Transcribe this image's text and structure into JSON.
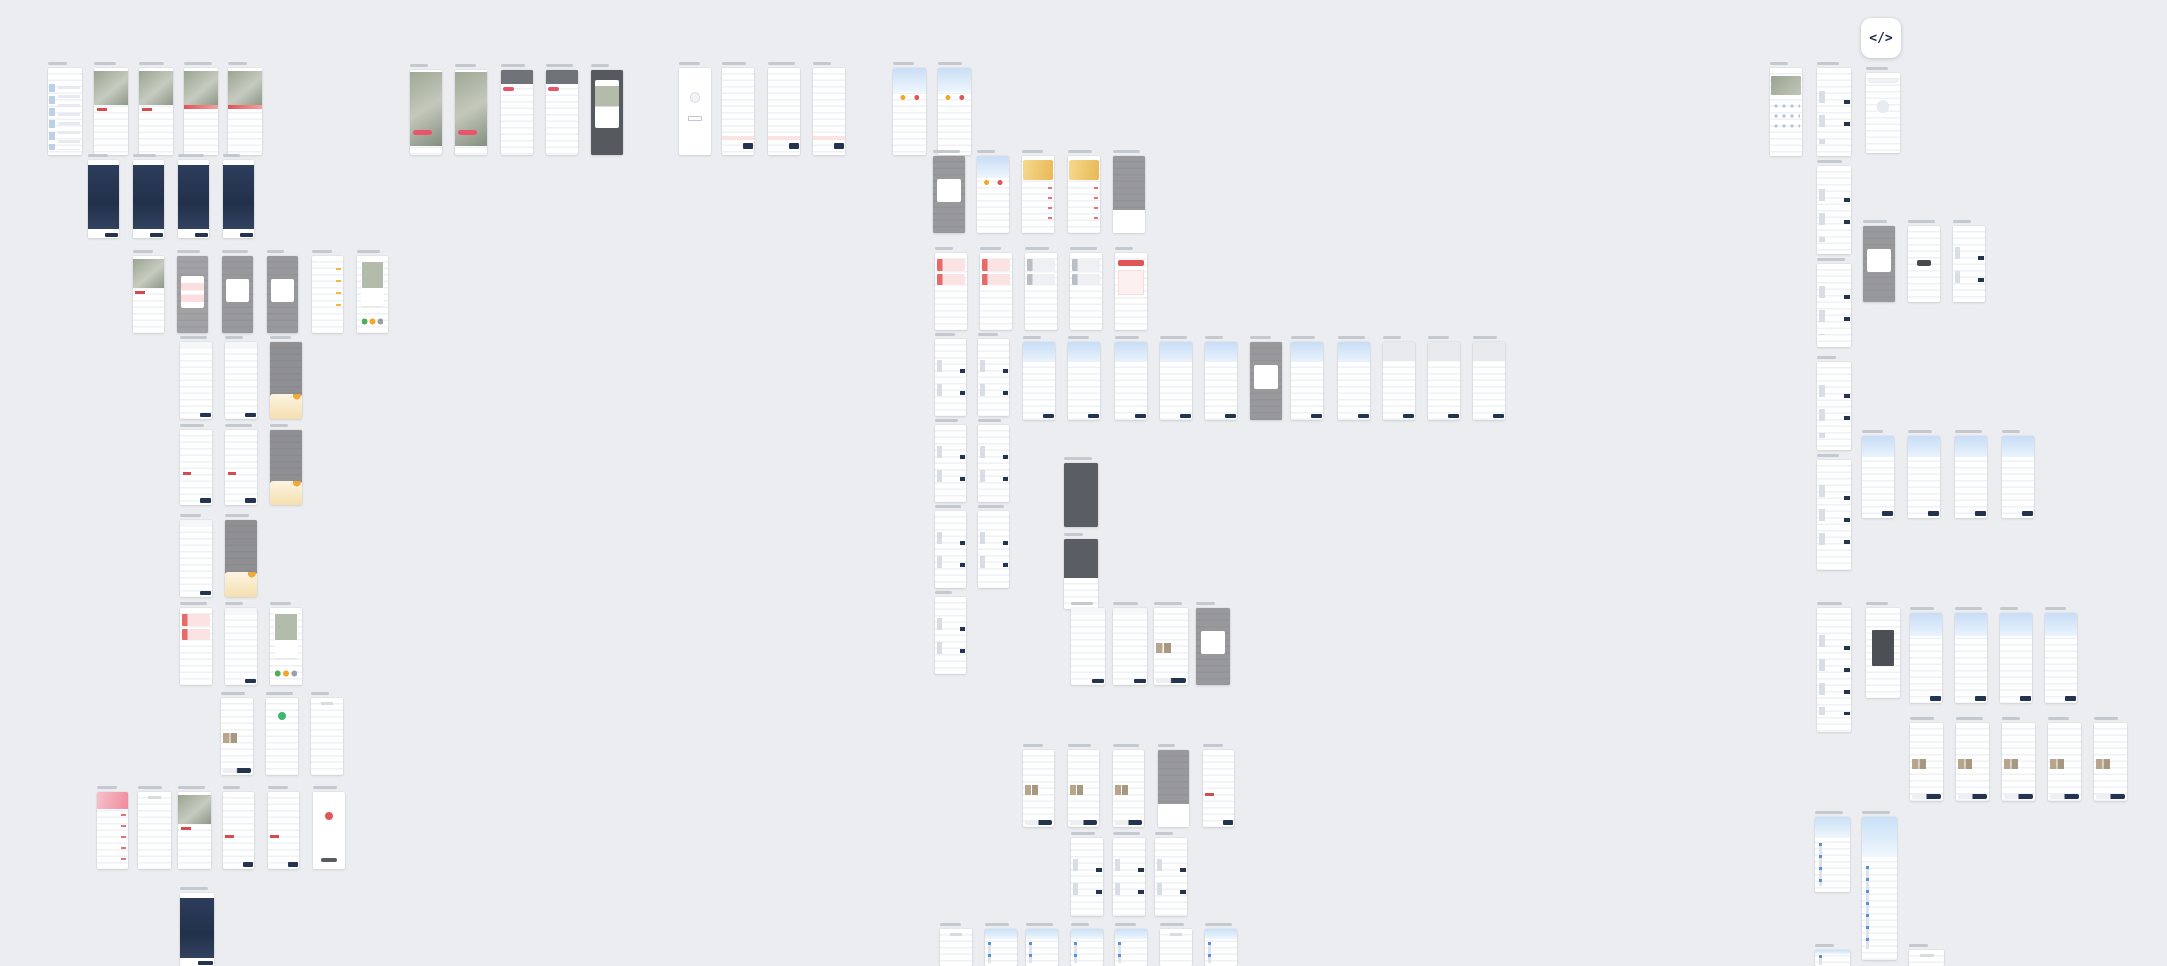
{
  "canvas": {
    "width": 2167,
    "height": 966,
    "background": "#ebedf0"
  },
  "code_button": {
    "label": "</>",
    "x": 1861,
    "y": 18,
    "size": 40
  },
  "colors": {
    "canvas_bg": "#ebedf0",
    "frame_bg": "#ffffff",
    "label_gray": "#c4c8cf",
    "brand_navy": "#24344f",
    "accent_red": "#e05555",
    "accent_pink": "#fbe3e3",
    "header_blue": "#cfe3f7",
    "wallet_gold": "#e9b857",
    "success_green": "#3cb96b",
    "warn_orange": "#f5a623",
    "photo_tone": "#9aa491",
    "dim_overlay": "rgba(70,70,74,0.55)"
  },
  "frames": [
    {
      "x": 48,
      "y": 68,
      "w": 34,
      "h": 87,
      "k": "list-blue"
    },
    {
      "x": 94,
      "y": 68,
      "w": 34,
      "h": 87,
      "k": "detail"
    },
    {
      "x": 139,
      "y": 68,
      "w": 34,
      "h": 87,
      "k": "detail"
    },
    {
      "x": 184,
      "y": 68,
      "w": 34,
      "h": 87,
      "k": "detail-banner"
    },
    {
      "x": 228,
      "y": 68,
      "w": 34,
      "h": 87,
      "k": "detail-banner"
    },
    {
      "x": 88,
      "y": 160,
      "w": 31,
      "h": 78,
      "k": "navy"
    },
    {
      "x": 133,
      "y": 160,
      "w": 31,
      "h": 78,
      "k": "navy"
    },
    {
      "x": 178,
      "y": 160,
      "w": 31,
      "h": 78,
      "k": "navy"
    },
    {
      "x": 223,
      "y": 160,
      "w": 31,
      "h": 78,
      "k": "navy"
    },
    {
      "x": 133,
      "y": 256,
      "w": 31,
      "h": 77,
      "k": "detail"
    },
    {
      "x": 177,
      "y": 256,
      "w": 31,
      "h": 77,
      "k": "dim-pink"
    },
    {
      "x": 222,
      "y": 256,
      "w": 31,
      "h": 77,
      "k": "dim-card"
    },
    {
      "x": 267,
      "y": 256,
      "w": 31,
      "h": 77,
      "k": "dim-card"
    },
    {
      "x": 312,
      "y": 256,
      "w": 31,
      "h": 77,
      "k": "reviews"
    },
    {
      "x": 357,
      "y": 256,
      "w": 31,
      "h": 77,
      "k": "share"
    },
    {
      "x": 180,
      "y": 342,
      "w": 32,
      "h": 77,
      "k": "form"
    },
    {
      "x": 225,
      "y": 342,
      "w": 32,
      "h": 77,
      "k": "form"
    },
    {
      "x": 270,
      "y": 342,
      "w": 32,
      "h": 77,
      "k": "dim-gold"
    },
    {
      "x": 180,
      "y": 430,
      "w": 32,
      "h": 75,
      "k": "pay"
    },
    {
      "x": 225,
      "y": 430,
      "w": 32,
      "h": 75,
      "k": "pay"
    },
    {
      "x": 270,
      "y": 430,
      "w": 32,
      "h": 75,
      "k": "dim-gold"
    },
    {
      "x": 180,
      "y": 520,
      "w": 32,
      "h": 77,
      "k": "form"
    },
    {
      "x": 225,
      "y": 520,
      "w": 32,
      "h": 77,
      "k": "dim-gold"
    },
    {
      "x": 180,
      "y": 608,
      "w": 32,
      "h": 77,
      "k": "coupons"
    },
    {
      "x": 225,
      "y": 608,
      "w": 32,
      "h": 77,
      "k": "form"
    },
    {
      "x": 270,
      "y": 608,
      "w": 32,
      "h": 77,
      "k": "share"
    },
    {
      "x": 221,
      "y": 698,
      "w": 32,
      "h": 77,
      "k": "aftersale"
    },
    {
      "x": 266,
      "y": 698,
      "w": 32,
      "h": 77,
      "k": "success"
    },
    {
      "x": 311,
      "y": 698,
      "w": 32,
      "h": 77,
      "k": "doc"
    },
    {
      "x": 97,
      "y": 792,
      "w": 31,
      "h": 77,
      "k": "promo"
    },
    {
      "x": 138,
      "y": 792,
      "w": 33,
      "h": 77,
      "k": "doc"
    },
    {
      "x": 178,
      "y": 792,
      "w": 33,
      "h": 77,
      "k": "detail"
    },
    {
      "x": 223,
      "y": 792,
      "w": 31,
      "h": 77,
      "k": "pay"
    },
    {
      "x": 268,
      "y": 792,
      "w": 31,
      "h": 77,
      "k": "pay"
    },
    {
      "x": 313,
      "y": 792,
      "w": 32,
      "h": 77,
      "k": "error"
    },
    {
      "x": 180,
      "y": 893,
      "w": 34,
      "h": 73,
      "k": "navy"
    },
    {
      "x": 410,
      "y": 70,
      "w": 32,
      "h": 85,
      "k": "feed"
    },
    {
      "x": 455,
      "y": 70,
      "w": 32,
      "h": 85,
      "k": "feed"
    },
    {
      "x": 501,
      "y": 70,
      "w": 32,
      "h": 85,
      "k": "comments"
    },
    {
      "x": 546,
      "y": 70,
      "w": 32,
      "h": 85,
      "k": "comments"
    },
    {
      "x": 591,
      "y": 70,
      "w": 32,
      "h": 85,
      "k": "dark-card"
    },
    {
      "x": 679,
      "y": 68,
      "w": 32,
      "h": 87,
      "k": "empty"
    },
    {
      "x": 722,
      "y": 68,
      "w": 32,
      "h": 87,
      "k": "cart"
    },
    {
      "x": 768,
      "y": 68,
      "w": 32,
      "h": 87,
      "k": "cart"
    },
    {
      "x": 813,
      "y": 68,
      "w": 32,
      "h": 87,
      "k": "cart"
    },
    {
      "x": 893,
      "y": 68,
      "w": 33,
      "h": 87,
      "k": "profile"
    },
    {
      "x": 938,
      "y": 68,
      "w": 33,
      "h": 87,
      "k": "profile"
    },
    {
      "x": 933,
      "y": 156,
      "w": 32,
      "h": 77,
      "k": "dim-card"
    },
    {
      "x": 977,
      "y": 156,
      "w": 32,
      "h": 77,
      "k": "profile"
    },
    {
      "x": 1022,
      "y": 156,
      "w": 32,
      "h": 77,
      "k": "wallet"
    },
    {
      "x": 1068,
      "y": 156,
      "w": 32,
      "h": 77,
      "k": "wallet"
    },
    {
      "x": 1113,
      "y": 156,
      "w": 32,
      "h": 77,
      "k": "dim-sheet"
    },
    {
      "x": 935,
      "y": 253,
      "w": 32,
      "h": 77,
      "k": "coupons"
    },
    {
      "x": 980,
      "y": 253,
      "w": 32,
      "h": 77,
      "k": "coupons"
    },
    {
      "x": 1025,
      "y": 253,
      "w": 32,
      "h": 77,
      "k": "coupons-gray"
    },
    {
      "x": 1070,
      "y": 253,
      "w": 32,
      "h": 77,
      "k": "coupons-gray"
    },
    {
      "x": 1115,
      "y": 253,
      "w": 32,
      "h": 77,
      "k": "red-btn"
    },
    {
      "x": 935,
      "y": 339,
      "w": 31,
      "h": 77,
      "k": "list"
    },
    {
      "x": 935,
      "y": 425,
      "w": 31,
      "h": 77,
      "k": "list"
    },
    {
      "x": 935,
      "y": 511,
      "w": 31,
      "h": 77,
      "k": "list"
    },
    {
      "x": 935,
      "y": 597,
      "w": 31,
      "h": 77,
      "k": "list"
    },
    {
      "x": 978,
      "y": 339,
      "w": 31,
      "h": 77,
      "k": "list"
    },
    {
      "x": 978,
      "y": 425,
      "w": 31,
      "h": 77,
      "k": "list"
    },
    {
      "x": 978,
      "y": 511,
      "w": 31,
      "h": 77,
      "k": "list"
    },
    {
      "x": 1023,
      "y": 342,
      "w": 32,
      "h": 78,
      "k": "order-blue"
    },
    {
      "x": 1068,
      "y": 342,
      "w": 32,
      "h": 78,
      "k": "order-blue"
    },
    {
      "x": 1115,
      "y": 342,
      "w": 32,
      "h": 78,
      "k": "order-blue"
    },
    {
      "x": 1160,
      "y": 342,
      "w": 32,
      "h": 78,
      "k": "order-blue"
    },
    {
      "x": 1205,
      "y": 342,
      "w": 32,
      "h": 78,
      "k": "order-blue"
    },
    {
      "x": 1250,
      "y": 342,
      "w": 32,
      "h": 78,
      "k": "dim-card"
    },
    {
      "x": 1291,
      "y": 342,
      "w": 32,
      "h": 78,
      "k": "order-blue"
    },
    {
      "x": 1338,
      "y": 342,
      "w": 32,
      "h": 78,
      "k": "order-blue"
    },
    {
      "x": 1383,
      "y": 342,
      "w": 32,
      "h": 78,
      "k": "order-gray"
    },
    {
      "x": 1428,
      "y": 342,
      "w": 32,
      "h": 78,
      "k": "order-gray"
    },
    {
      "x": 1473,
      "y": 342,
      "w": 32,
      "h": 78,
      "k": "order-gray"
    },
    {
      "x": 1064,
      "y": 463,
      "w": 34,
      "h": 64,
      "k": "dark"
    },
    {
      "x": 1064,
      "y": 539,
      "w": 34,
      "h": 70,
      "k": "dark-split"
    },
    {
      "x": 1071,
      "y": 608,
      "w": 34,
      "h": 77,
      "k": "form"
    },
    {
      "x": 1113,
      "y": 608,
      "w": 34,
      "h": 77,
      "k": "form"
    },
    {
      "x": 1154,
      "y": 608,
      "w": 34,
      "h": 77,
      "k": "aftersale"
    },
    {
      "x": 1196,
      "y": 608,
      "w": 34,
      "h": 77,
      "k": "dim-card"
    },
    {
      "x": 1023,
      "y": 750,
      "w": 31,
      "h": 77,
      "k": "aftersale"
    },
    {
      "x": 1068,
      "y": 750,
      "w": 31,
      "h": 77,
      "k": "aftersale"
    },
    {
      "x": 1113,
      "y": 750,
      "w": 31,
      "h": 77,
      "k": "aftersale"
    },
    {
      "x": 1158,
      "y": 750,
      "w": 31,
      "h": 77,
      "k": "dim-sheet"
    },
    {
      "x": 1203,
      "y": 750,
      "w": 31,
      "h": 77,
      "k": "pay"
    },
    {
      "x": 1071,
      "y": 838,
      "w": 32,
      "h": 78,
      "k": "list"
    },
    {
      "x": 1113,
      "y": 838,
      "w": 32,
      "h": 78,
      "k": "list"
    },
    {
      "x": 1155,
      "y": 838,
      "w": 32,
      "h": 78,
      "k": "list"
    },
    {
      "x": 940,
      "y": 929,
      "w": 32,
      "h": 37,
      "k": "doc"
    },
    {
      "x": 985,
      "y": 929,
      "w": 32,
      "h": 37,
      "k": "logistics"
    },
    {
      "x": 1026,
      "y": 929,
      "w": 32,
      "h": 37,
      "k": "logistics"
    },
    {
      "x": 1071,
      "y": 929,
      "w": 32,
      "h": 37,
      "k": "logistics"
    },
    {
      "x": 1115,
      "y": 929,
      "w": 32,
      "h": 37,
      "k": "logistics"
    },
    {
      "x": 1160,
      "y": 929,
      "w": 32,
      "h": 37,
      "k": "doc"
    },
    {
      "x": 1205,
      "y": 929,
      "w": 32,
      "h": 37,
      "k": "logistics"
    },
    {
      "x": 1770,
      "y": 68,
      "w": 32,
      "h": 88,
      "k": "home"
    },
    {
      "x": 1817,
      "y": 68,
      "w": 34,
      "h": 88,
      "k": "list"
    },
    {
      "x": 1817,
      "y": 166,
      "w": 34,
      "h": 88,
      "k": "list"
    },
    {
      "x": 1817,
      "y": 264,
      "w": 34,
      "h": 83,
      "k": "list"
    },
    {
      "x": 1817,
      "y": 362,
      "w": 34,
      "h": 88,
      "k": "list"
    },
    {
      "x": 1817,
      "y": 460,
      "w": 34,
      "h": 110,
      "k": "list"
    },
    {
      "x": 1817,
      "y": 608,
      "w": 34,
      "h": 124,
      "k": "list"
    },
    {
      "x": 1815,
      "y": 817,
      "w": 35,
      "h": 75,
      "k": "logistics"
    },
    {
      "x": 1815,
      "y": 950,
      "w": 35,
      "h": 16,
      "k": "logistics"
    },
    {
      "x": 1866,
      "y": 73,
      "w": 34,
      "h": 80,
      "k": "search"
    },
    {
      "x": 1863,
      "y": 226,
      "w": 32,
      "h": 76,
      "k": "dim-card"
    },
    {
      "x": 1908,
      "y": 226,
      "w": 32,
      "h": 76,
      "k": "toast"
    },
    {
      "x": 1953,
      "y": 226,
      "w": 32,
      "h": 76,
      "k": "list"
    },
    {
      "x": 1862,
      "y": 436,
      "w": 32,
      "h": 82,
      "k": "order-blue"
    },
    {
      "x": 1908,
      "y": 436,
      "w": 32,
      "h": 82,
      "k": "order-blue"
    },
    {
      "x": 1955,
      "y": 436,
      "w": 32,
      "h": 82,
      "k": "order-blue"
    },
    {
      "x": 2002,
      "y": 436,
      "w": 32,
      "h": 82,
      "k": "order-blue"
    },
    {
      "x": 1866,
      "y": 608,
      "w": 34,
      "h": 90,
      "k": "wcard"
    },
    {
      "x": 1910,
      "y": 613,
      "w": 32,
      "h": 90,
      "k": "order-blue"
    },
    {
      "x": 1955,
      "y": 613,
      "w": 32,
      "h": 90,
      "k": "order-blue"
    },
    {
      "x": 2000,
      "y": 613,
      "w": 32,
      "h": 90,
      "k": "order-blue"
    },
    {
      "x": 2045,
      "y": 613,
      "w": 32,
      "h": 90,
      "k": "order-blue"
    },
    {
      "x": 1910,
      "y": 723,
      "w": 33,
      "h": 78,
      "k": "aftersale"
    },
    {
      "x": 1956,
      "y": 723,
      "w": 33,
      "h": 78,
      "k": "aftersale"
    },
    {
      "x": 2002,
      "y": 723,
      "w": 33,
      "h": 78,
      "k": "aftersale"
    },
    {
      "x": 2048,
      "y": 723,
      "w": 33,
      "h": 78,
      "k": "aftersale"
    },
    {
      "x": 2094,
      "y": 723,
      "w": 33,
      "h": 78,
      "k": "aftersale"
    },
    {
      "x": 1862,
      "y": 817,
      "w": 35,
      "h": 143,
      "k": "logistics"
    },
    {
      "x": 1909,
      "y": 950,
      "w": 35,
      "h": 16,
      "k": "doc"
    }
  ]
}
